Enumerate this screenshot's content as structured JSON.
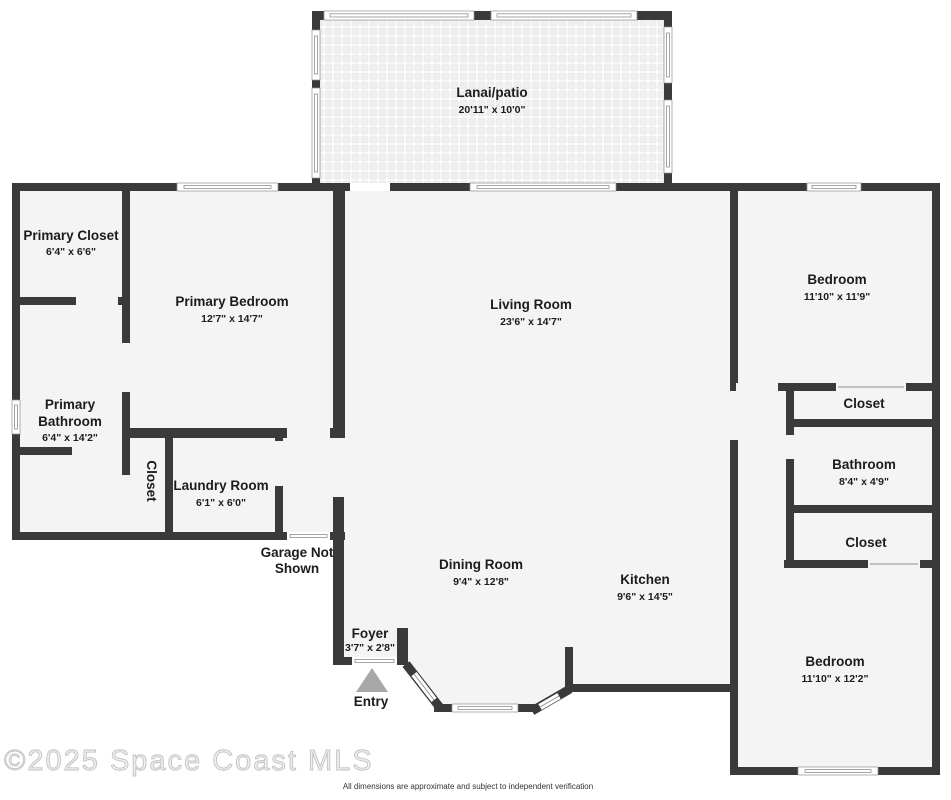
{
  "floorplan": {
    "watermark": "©2025 Space Coast MLS",
    "disclaimer": "All dimensions are approximate and subject to independent verification",
    "entry_label": "Entry",
    "garage_note_line1": "Garage Not",
    "garage_note_line2": "Shown",
    "rooms": {
      "lanai": {
        "name": "Lanai/patio",
        "dims": "20'11\" x 10'0\""
      },
      "primary_closet": {
        "name": "Primary Closet",
        "dims": "6'4\" x 6'6\""
      },
      "primary_bedroom": {
        "name": "Primary Bedroom",
        "dims": "12'7\" x 14'7\""
      },
      "living_room": {
        "name": "Living Room",
        "dims": "23'6\" x 14'7\""
      },
      "bedroom_top_right": {
        "name": "Bedroom",
        "dims": "11'10\" x 11'9\""
      },
      "closet_top_right": {
        "name": "Closet"
      },
      "bathroom_right": {
        "name": "Bathroom",
        "dims": "8'4\" x 4'9\""
      },
      "closet_mid_right": {
        "name": "Closet"
      },
      "bedroom_bottom_right": {
        "name": "Bedroom",
        "dims": "11'10\" x 12'2\""
      },
      "primary_bathroom": {
        "name_line1": "Primary",
        "name_line2": "Bathroom",
        "dims": "6'4\" x 14'2\""
      },
      "hall_closet": {
        "name": "Closet"
      },
      "laundry_room": {
        "name": "Laundry Room",
        "dims": "6'1\" x 6'0\""
      },
      "dining_room": {
        "name": "Dining Room",
        "dims": "9'4\" x 12'8\""
      },
      "kitchen": {
        "name": "Kitchen",
        "dims": "9'6\" x 14'5\""
      },
      "foyer": {
        "name": "Foyer",
        "dims": "3'7\" x 2'8\""
      }
    },
    "colors": {
      "wall": "#3a3a3a",
      "floor": "#f4f4f4",
      "entry": "#a8a8a8",
      "watermark_fill": "#efefef",
      "watermark_stroke": "#c2c2c2"
    }
  }
}
